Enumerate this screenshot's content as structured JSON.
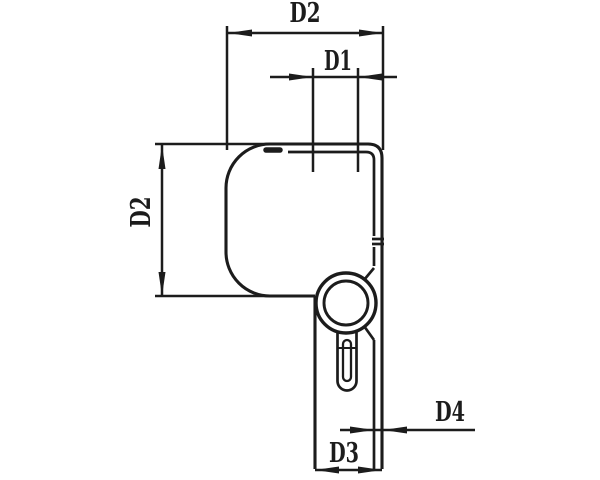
{
  "drawing": {
    "type": "technical-dimension-drawing",
    "labels": {
      "d2_top": "D2",
      "d1": "D1",
      "d2_left": "D2",
      "d3": "D3",
      "d4": "D4"
    }
  },
  "colors": {
    "line": "#1c1c1c",
    "background": "#ffffff"
  }
}
